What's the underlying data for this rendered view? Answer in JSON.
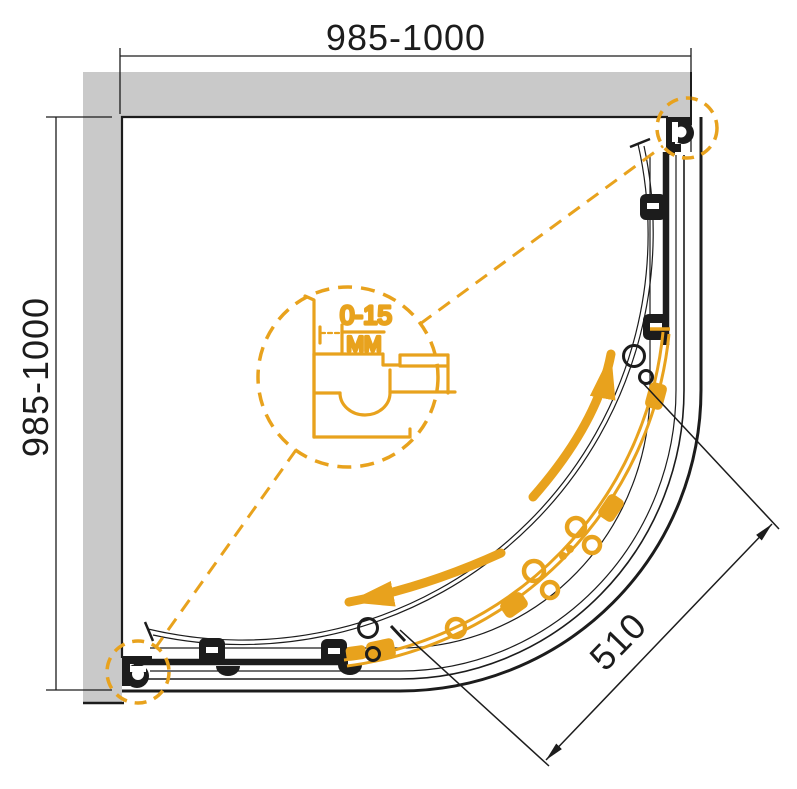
{
  "drawing": {
    "dimensions": {
      "width_top": "985-1000",
      "depth_left": "985-1000",
      "entry_diagonal": "510"
    },
    "detail_callout": {
      "adjustment_range": "0-15",
      "unit": "MM"
    },
    "colors": {
      "accent_orange": "#e8a21d",
      "wall_gray": "#c9c9c9",
      "line_black": "#1c1c1c",
      "background": "#ffffff"
    }
  }
}
